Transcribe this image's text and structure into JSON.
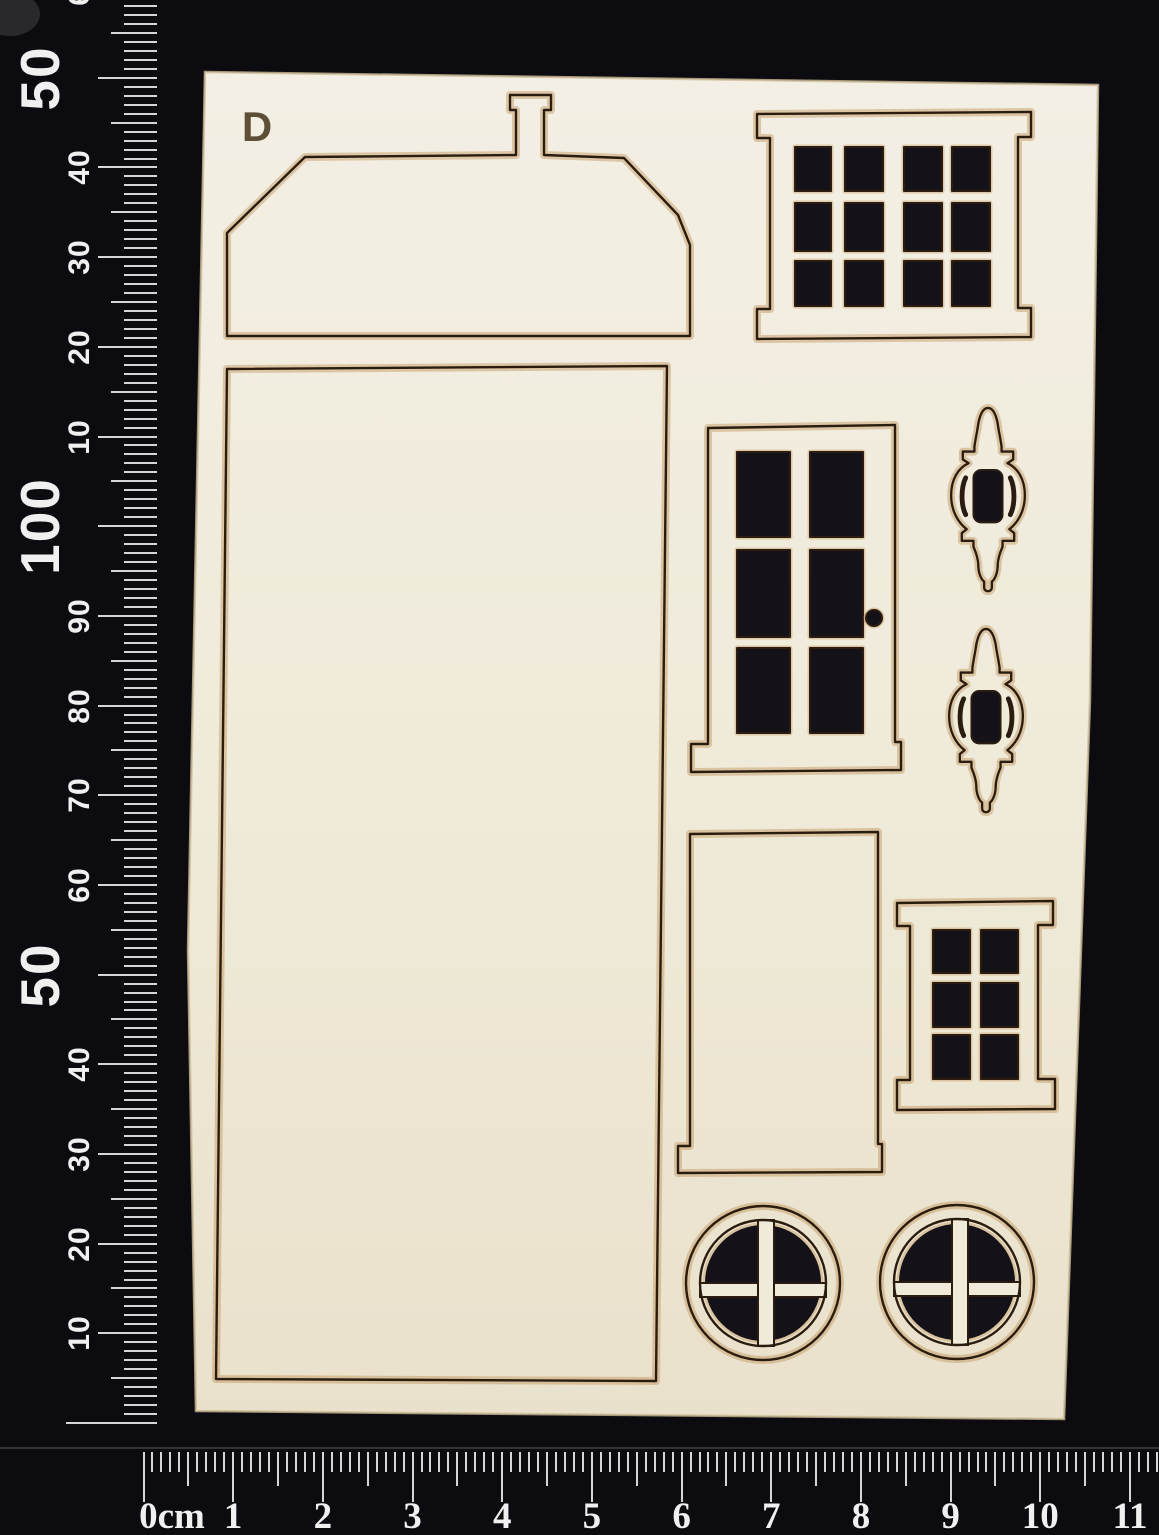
{
  "scene": {
    "type": "product-photo",
    "description": "Sheet of laser-cut cream chipboard dollhouse facade pieces marked D, photographed on a black background with millimetre rulers along the left and bottom edges",
    "board_label": "D"
  },
  "colors": {
    "background": "#0b0b10",
    "board": "#efead9",
    "board_light": "#f3efe4",
    "board_dark": "#e7ddc6",
    "scorch": "#c2945c",
    "cut_line": "#2a1c0e",
    "hole": "#141119",
    "tick": "#e8e8e8",
    "ruler_text": "#f0f0f0"
  },
  "pieces": [
    {
      "name": "roof-gable-with-chimney",
      "description": "roof gable piece with chimney stub"
    },
    {
      "name": "house-front-panel",
      "description": "large rectangular house front panel"
    },
    {
      "name": "window-twelve-pane",
      "description": "window frame with 4x3 grid of square panes"
    },
    {
      "name": "door-six-pane",
      "description": "door with 2x3 panes and round doorknob hole"
    },
    {
      "name": "finial-ornament-upper",
      "description": "decorative lantern finial ornament"
    },
    {
      "name": "finial-ornament-lower",
      "description": "decorative lantern finial ornament"
    },
    {
      "name": "door-backing-panel",
      "description": "plain door-shaped backing panel"
    },
    {
      "name": "window-six-pane",
      "description": "small window frame with 2x3 panes"
    },
    {
      "name": "round-window-left",
      "description": "circular porthole window with cross mullion"
    },
    {
      "name": "round-window-right",
      "description": "circular porthole window with cross mullion"
    }
  ],
  "vertical_ruler": {
    "unit": "mm",
    "labels": [
      {
        "mm": 10,
        "text": "10",
        "big": false
      },
      {
        "mm": 20,
        "text": "20",
        "big": false
      },
      {
        "mm": 30,
        "text": "30",
        "big": false
      },
      {
        "mm": 40,
        "text": "40",
        "big": false
      },
      {
        "mm": 50,
        "text": "50",
        "big": true
      },
      {
        "mm": 60,
        "text": "60",
        "big": false
      },
      {
        "mm": 70,
        "text": "70",
        "big": false
      },
      {
        "mm": 80,
        "text": "80",
        "big": false
      },
      {
        "mm": 90,
        "text": "90",
        "big": false
      },
      {
        "mm": 100,
        "text": "100",
        "big": true
      },
      {
        "mm": 110,
        "text": "10",
        "big": false
      },
      {
        "mm": 120,
        "text": "20",
        "big": false
      },
      {
        "mm": 130,
        "text": "30",
        "big": false
      },
      {
        "mm": 140,
        "text": "40",
        "big": false
      },
      {
        "mm": 150,
        "text": "50",
        "big": true
      },
      {
        "mm": 160,
        "text": "60",
        "big": false
      }
    ]
  },
  "horizontal_ruler": {
    "unit": "cm",
    "labels": [
      "0cm",
      "1",
      "2",
      "3",
      "4",
      "5",
      "6",
      "7",
      "8",
      "9",
      "10",
      "11"
    ]
  }
}
